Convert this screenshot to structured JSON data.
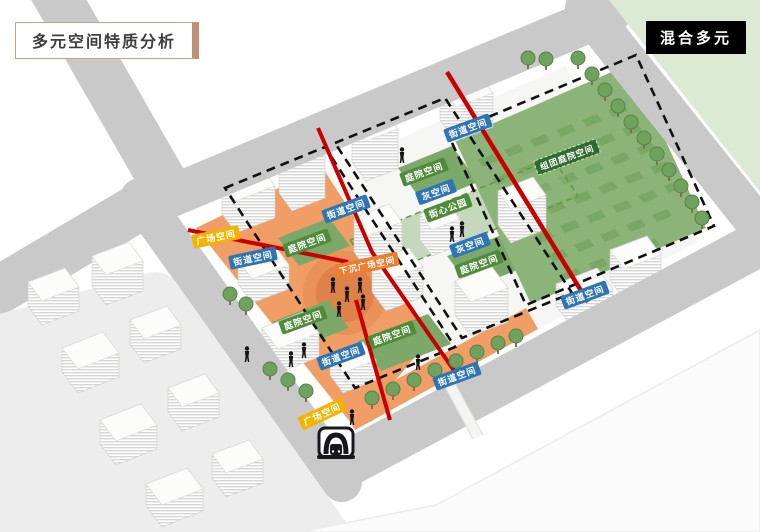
{
  "title": "多元空间特质分析",
  "tag": "混合多元",
  "colors": {
    "street_label": "#2e75b6",
    "courtyard_label": "#4f8c3a",
    "plaza_label": "#f5b301",
    "sunken_plaza_label": "#ed7d31",
    "cluster_courtyard_label": "#2f6b2f",
    "red_route": "#c80000",
    "road_gray": "#c9c9c9",
    "site_orange": "#f09d66",
    "big_green": "#8cb478",
    "block_green": "#dcead3"
  },
  "icons": {
    "metro": "metro-entrance-icon",
    "tree": "tree-icon",
    "person": "person-icon"
  },
  "labels": [
    {
      "text": "广场空间",
      "color": "#f5b301"
    },
    {
      "text": "街道空间",
      "color": "#2e75b6"
    },
    {
      "text": "庭院空间",
      "color": "#4f8c3a"
    },
    {
      "text": "街道空间",
      "color": "#2e75b6"
    },
    {
      "text": "下沉广场空间",
      "color": "#ed7d31"
    },
    {
      "text": "庭院空间",
      "color": "#4f8c3a"
    },
    {
      "text": "灰空间",
      "color": "#2e75b6"
    },
    {
      "text": "街心公园",
      "color": "#4f8c3a"
    },
    {
      "text": "街道空间",
      "color": "#2e75b6"
    },
    {
      "text": "组团庭院空间",
      "color": "#2f6b2f"
    },
    {
      "text": "灰空间",
      "color": "#2e75b6"
    },
    {
      "text": "庭院空间",
      "color": "#4f8c3a"
    },
    {
      "text": "庭院空间",
      "color": "#4f8c3a"
    },
    {
      "text": "庭院空间",
      "color": "#4f8c3a"
    },
    {
      "text": "街道空间",
      "color": "#2e75b6"
    },
    {
      "text": "街道空间",
      "color": "#2e75b6"
    },
    {
      "text": "街道空间",
      "color": "#2e75b6"
    },
    {
      "text": "广场空间",
      "color": "#f5b301"
    }
  ]
}
